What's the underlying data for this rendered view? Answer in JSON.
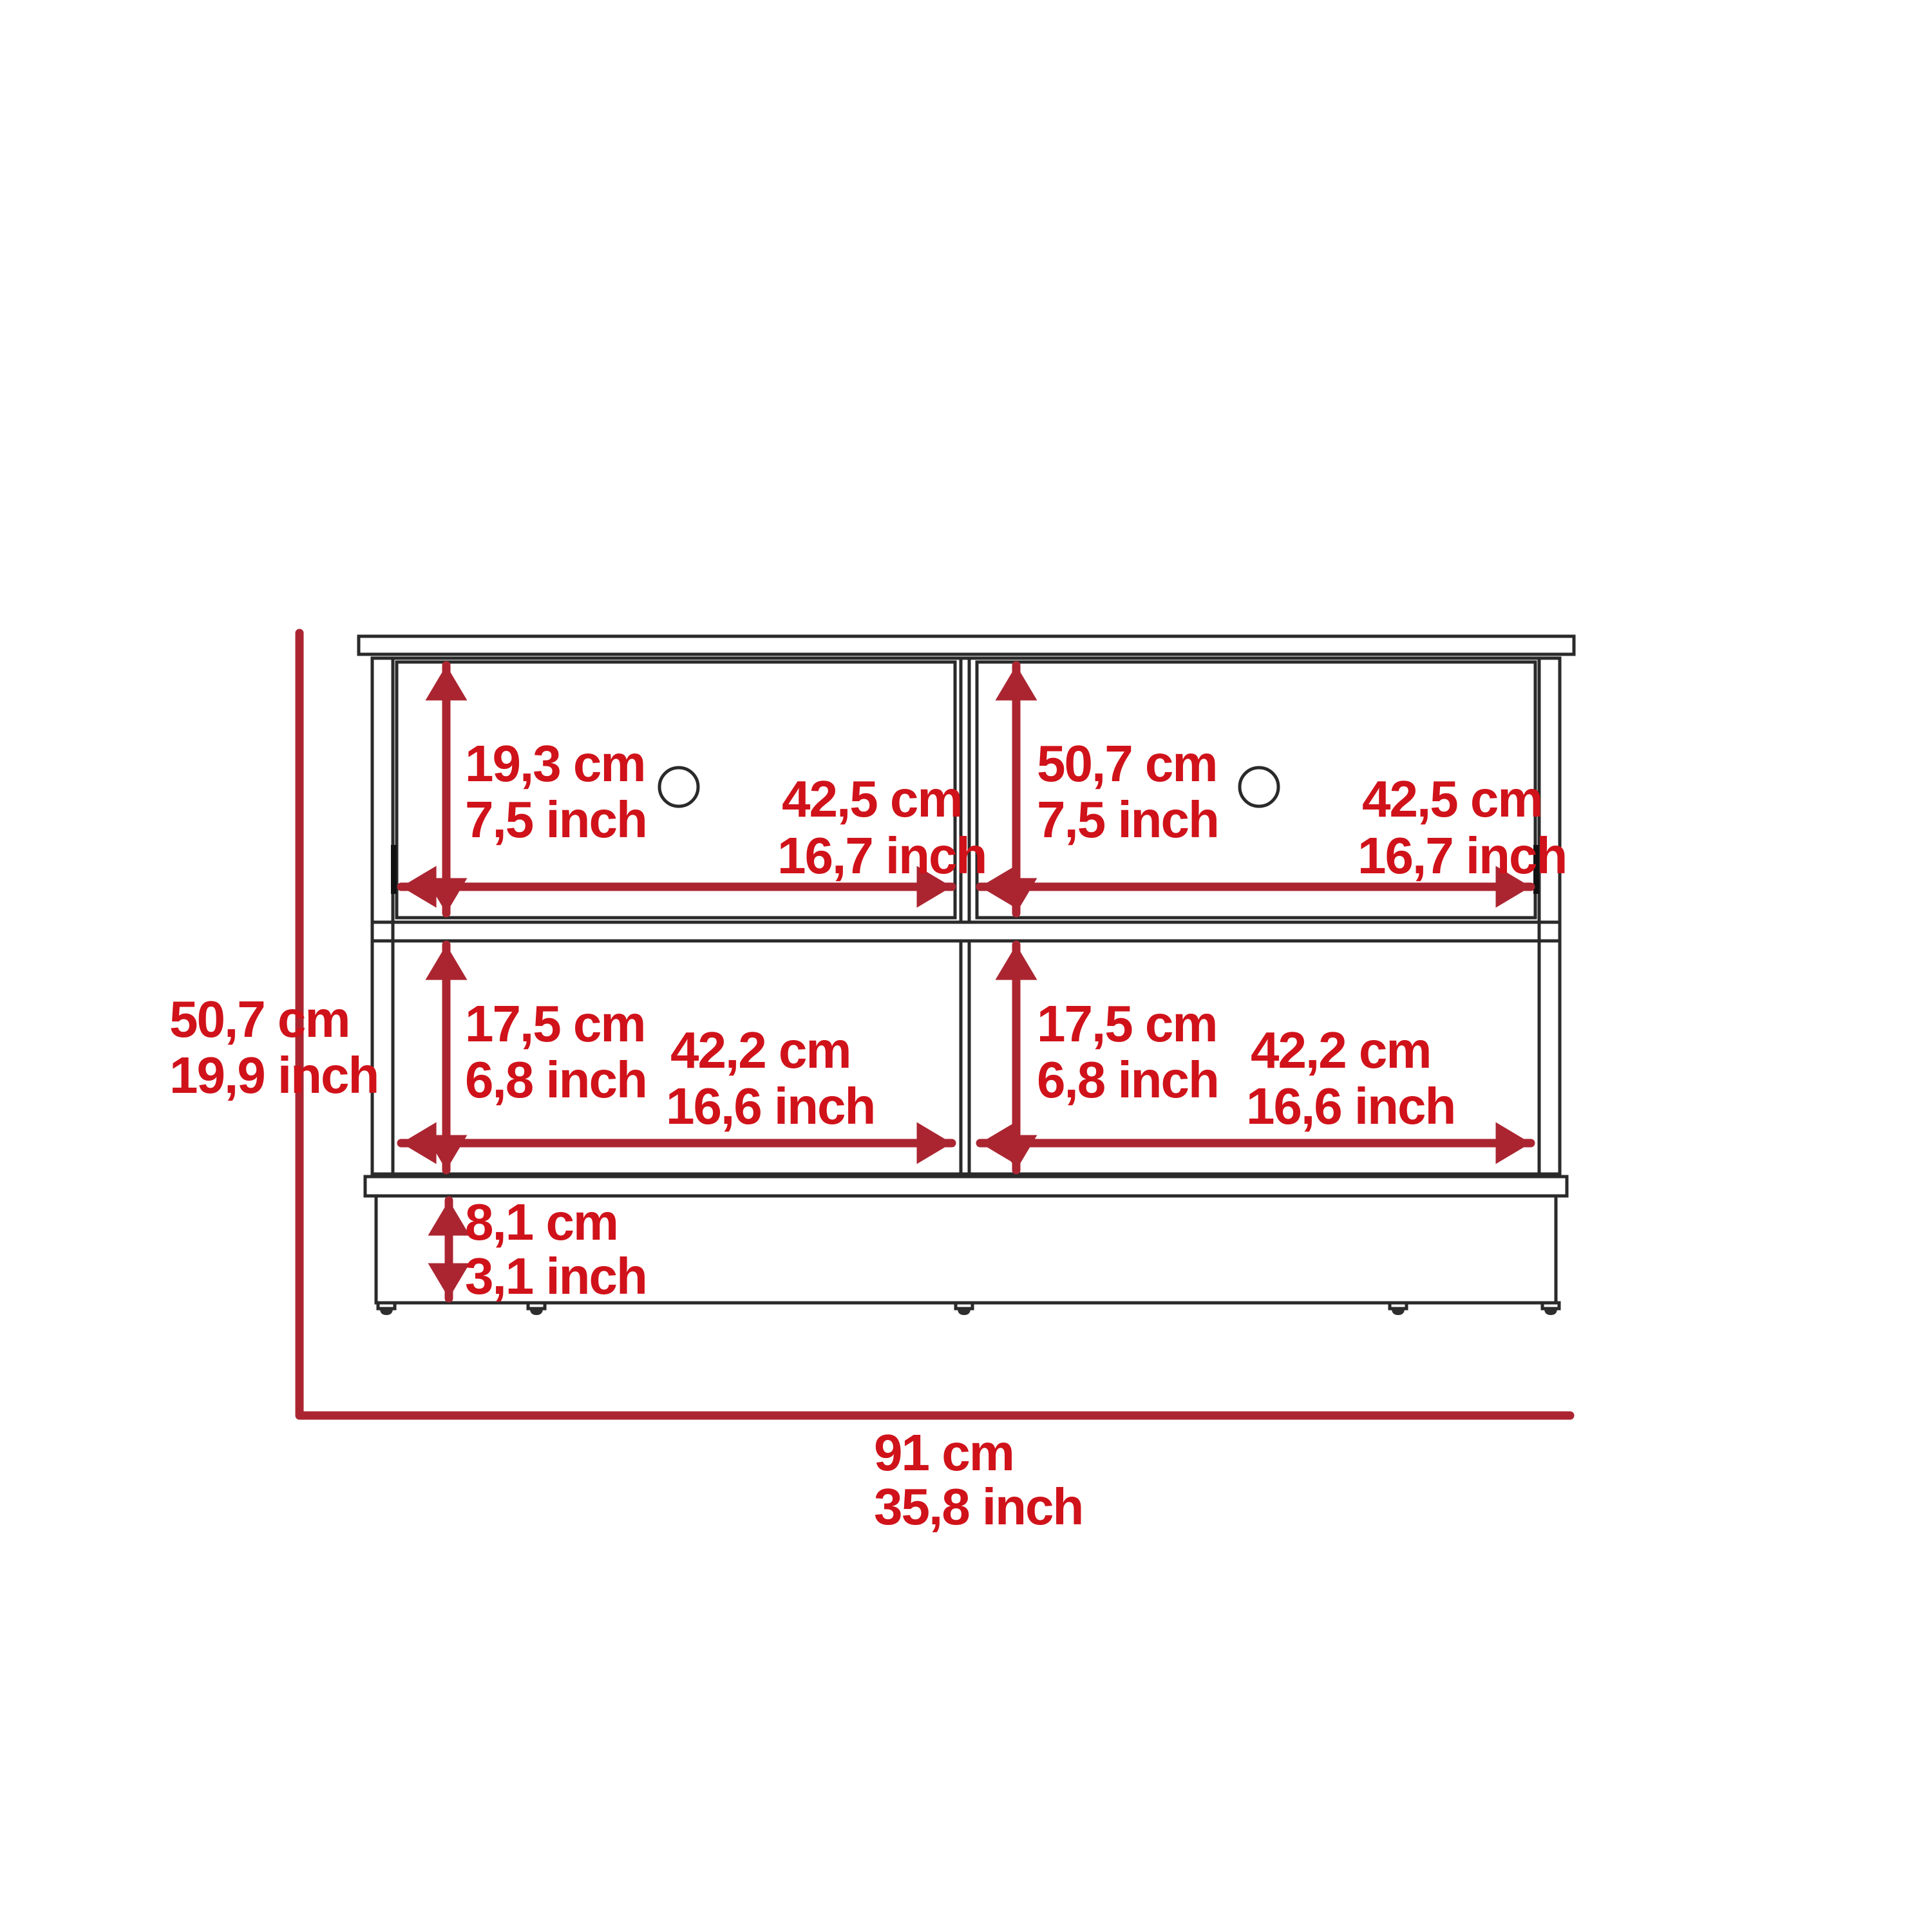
{
  "title": "storage-bench-dimension-diagram",
  "colors": {
    "dimension_line": "#ab2531",
    "dimension_text": "#d0121a",
    "outline": "#2a2a2a",
    "background": "#ffffff"
  },
  "overall": {
    "height_cm": "50,7 cm",
    "height_inch": "19,9 inch",
    "width_cm": "91 cm",
    "width_inch": "35,8 inch"
  },
  "drawer_left": {
    "height_cm": "19,3 cm",
    "height_inch": "7,5 inch",
    "width_cm": "42,5 cm",
    "width_inch": "16,7 inch"
  },
  "drawer_right": {
    "height_cm": "50,7 cm",
    "height_inch": "7,5 inch",
    "width_cm": "42,5 cm",
    "width_inch": "16,7 inch"
  },
  "shelf_left": {
    "height_cm": "17,5 cm",
    "height_inch": "6,8 inch",
    "width_cm": "42,2 cm",
    "width_inch": "16,6  inch"
  },
  "shelf_right": {
    "height_cm": "17,5 cm",
    "height_inch": "6,8 inch",
    "width_cm": "42,2 cm",
    "width_inch": "16,6  inch"
  },
  "base": {
    "height_cm": "8,1 cm",
    "height_inch": "3,1 inch"
  }
}
